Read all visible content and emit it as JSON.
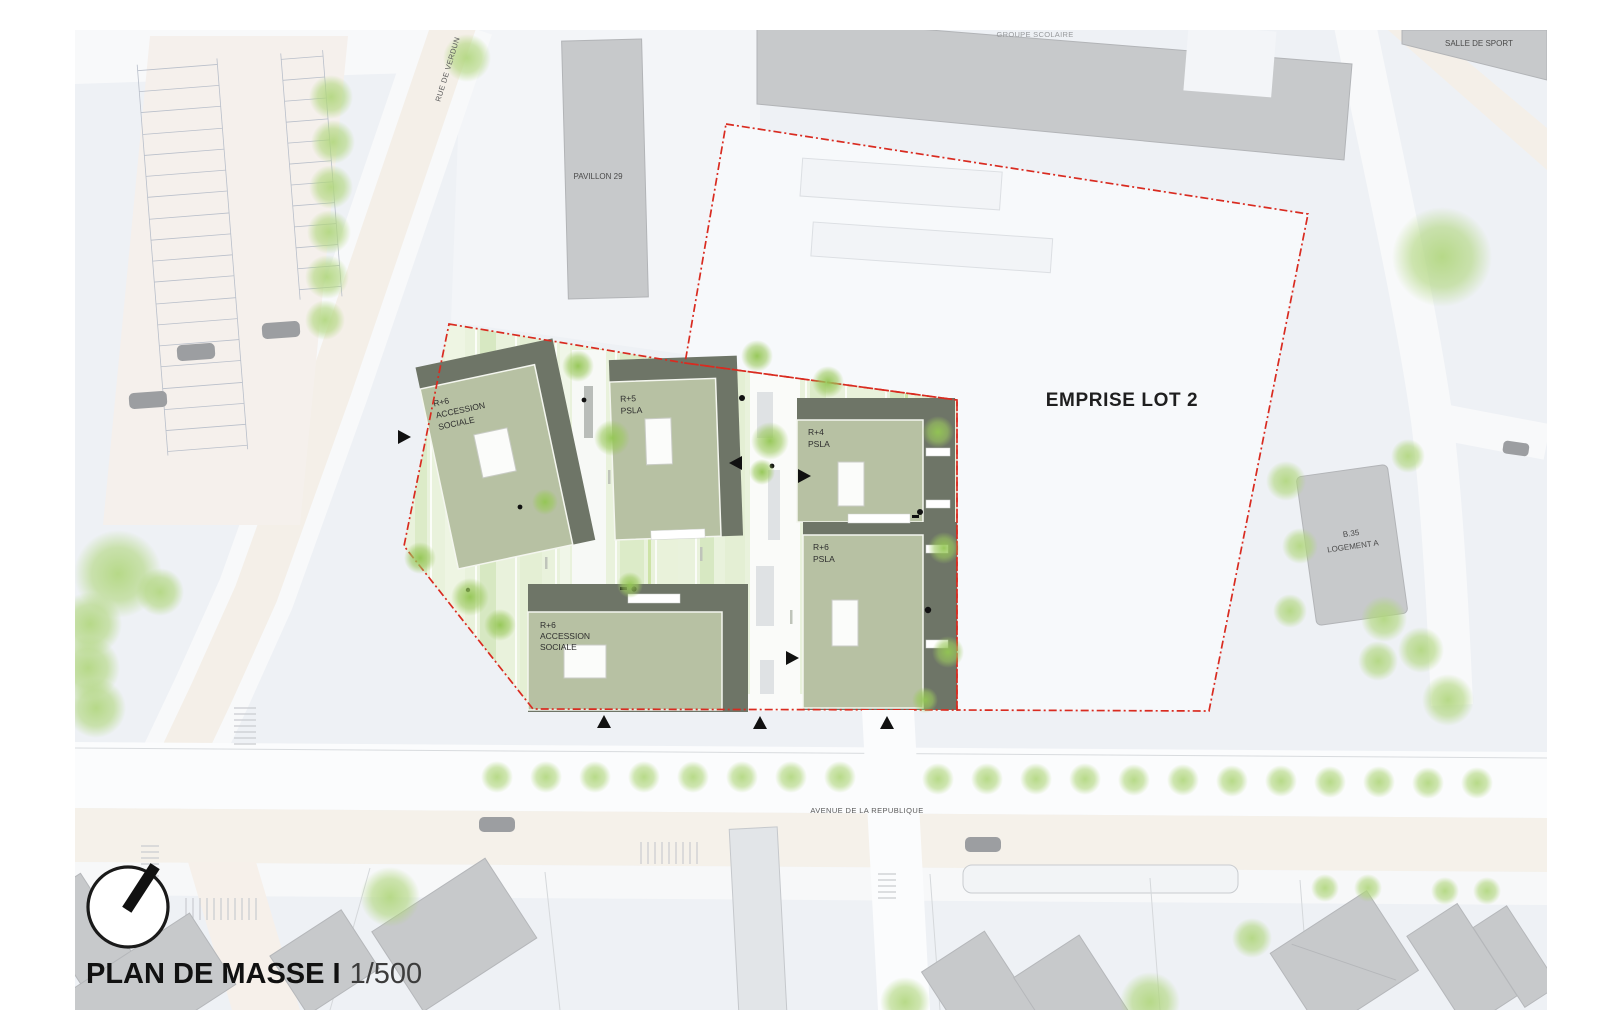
{
  "title": {
    "name": "PLAN DE MASSE I",
    "scale": "1/500"
  },
  "streets": {
    "vertical": "RUE DE VERDUN",
    "avenue": "AVENUE DE LA REPUBLIQUE"
  },
  "areas": {
    "school_label": "GROUPE SCOLAIRE",
    "sports_hall_label": "SALLE DE SPORT",
    "pavilion_label": "PAVILLON 29",
    "lot2_label": "EMPRISE LOT 2",
    "residence_line1": "B.35",
    "residence_line2": "LOGEMENT A"
  },
  "site_buildings": [
    {
      "id": "bldg-a",
      "lines": [
        "R+6",
        "ACCESSION",
        "SOCIALE"
      ]
    },
    {
      "id": "bldg-b",
      "lines": [
        "R+5",
        "PSLA"
      ]
    },
    {
      "id": "bldg-c",
      "lines": [
        "R+4",
        "PSLA"
      ]
    },
    {
      "id": "bldg-d",
      "lines": [
        "R+6",
        "PSLA"
      ]
    },
    {
      "id": "bldg-e",
      "lines": [
        "R+6",
        "ACCESSION",
        "SOCIALE"
      ]
    }
  ],
  "colors": {
    "boundary_red": "#d92b20",
    "roof_green": "#b7c1a3",
    "roof_shadow": "#6e7567",
    "site_green": "#e9f2dc",
    "building_gray": "#c7c9cb",
    "road_beige": "#f4efe8",
    "block_gray_blue": "#edf0f4",
    "tree_green": "#aed47e"
  }
}
